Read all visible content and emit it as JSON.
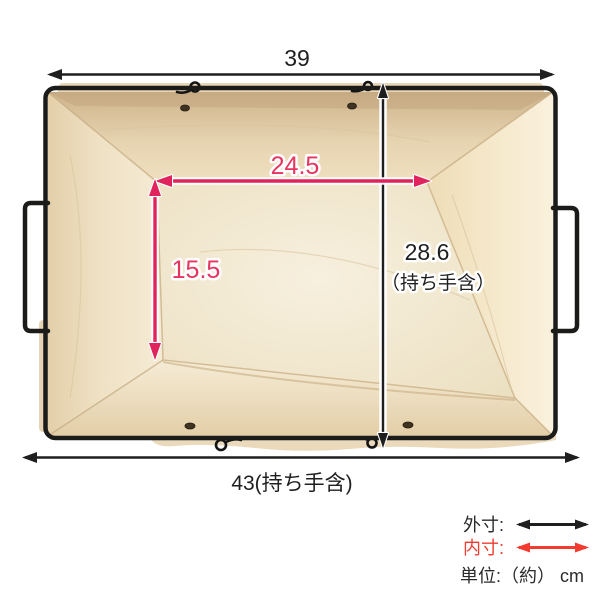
{
  "dimensions": {
    "outer_top_width": "39",
    "outer_bottom_width": "43(持ち手含)",
    "outer_height": "28.6",
    "outer_height_note": "（持ち手含）",
    "inner_width": "24.5",
    "inner_depth": "15.5"
  },
  "legend": {
    "outer_label": "外寸:",
    "inner_label": "内寸:",
    "unit_label": "単位:（約） cm"
  },
  "colors": {
    "outer_dimension": "#1f1f1f",
    "inner_dimension": "#e0235c",
    "inner_dimension_text": "#e8345f",
    "legend_inner_text": "#ef3c31",
    "legend_inner_arrow": "#f43b30",
    "wire_frame": "#1b1b19",
    "fabric_light": "#f7f0de",
    "fabric_dark": "#cdb38b",
    "background": "#ffffff"
  }
}
